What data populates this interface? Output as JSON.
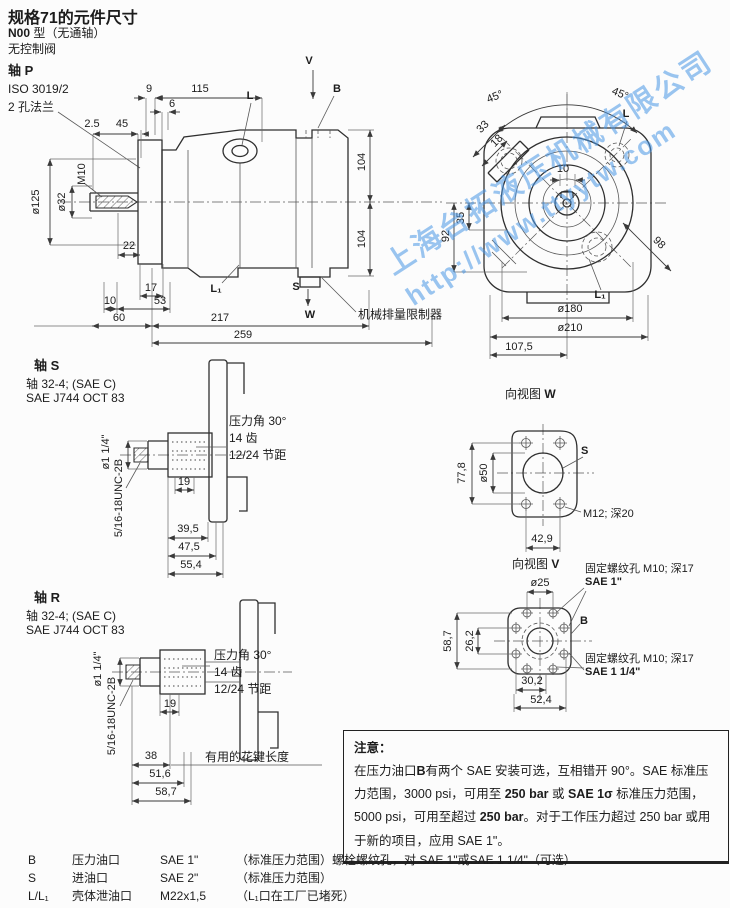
{
  "header": {
    "title": "规格71的元件尺寸",
    "model": "N00",
    "model_rest": " 型（无通轴）",
    "subtitle": "无控制阀"
  },
  "watermark": {
    "company": "上海台拓液压机械有限公司",
    "url": "http://www.ttyytw.com",
    "color": "#4a97e6"
  },
  "shaft_p": {
    "heading": "轴 P",
    "flange_std": "ISO 3019/2",
    "flange_type": "2 孔法兰",
    "dims": {
      "d9": "9",
      "d115": "115",
      "d6": "6",
      "d2_5": "2.5",
      "d45": "45",
      "dia125": "ø125",
      "dia32": "ø32",
      "m10": "M10",
      "d22": "22",
      "d17": "17",
      "d10": "10",
      "d53": "53",
      "d60": "60",
      "d217": "217",
      "d259": "259",
      "d104_top": "104",
      "d104_bottom": "104"
    },
    "ports": {
      "v": "V",
      "b": "B",
      "l": "L",
      "l1": "L₁",
      "s": "S",
      "w": "W"
    },
    "limiter_note": "机械排量限制器"
  },
  "rear_view": {
    "dims": {
      "a45_left": "45°",
      "a45_right": "45°",
      "d33": "33",
      "d18": "18",
      "d10": "10",
      "d92": "92",
      "d35": "35",
      "d98": "98",
      "dia180": "ø180",
      "dia210": "ø210",
      "d107_5": "107,5"
    },
    "ports": {
      "l": "L",
      "l1": "L₁"
    }
  },
  "shaft_s": {
    "heading": "轴 S",
    "spec_line1": "轴 32-4; (SAE C)",
    "spec_line2": "SAE J744 OCT 83",
    "dia": "ø1 1/4\"",
    "thread": "5/16-18UNC-2B",
    "dims": {
      "d19": "19",
      "d39_5": "39,5",
      "d47_5": "47,5",
      "d55_4": "55,4"
    },
    "spline": {
      "angle": "压力角 30°",
      "teeth": "14 齿",
      "pitch": "12/24 节距"
    }
  },
  "view_w": {
    "title_prefix": "向视图 ",
    "letter": "W",
    "dims": {
      "d77_8": "77,8",
      "dia50": "ø50",
      "d42_9": "42,9"
    },
    "port": "S",
    "hole_note": "M12; 深20"
  },
  "shaft_r": {
    "heading": "轴 R",
    "spec_line1": "轴 32-4; (SAE C)",
    "spec_line2": "SAE J744 OCT 83",
    "dia": "ø1 1/4\"",
    "thread": "5/16-18UNC-2B",
    "dims": {
      "d19": "19",
      "d38": "38",
      "d51_6": "51,6",
      "d58_7": "58,7"
    },
    "spline_length_note": "有用的花键长度",
    "spline": {
      "angle": "压力角 30°",
      "teeth": "14 齿",
      "pitch": "12/24 节距"
    }
  },
  "view_v": {
    "title_prefix": "向视图 ",
    "letter": "V",
    "dims": {
      "dia25": "ø25",
      "d58_7": "58,7",
      "d26_2": "26,2",
      "d30_2": "30,2",
      "d52_4": "52,4"
    },
    "port": "B",
    "fixing_note_top": "固定螺纹孔 M10; 深17",
    "sae_top": "SAE 1\"",
    "fixing_note_bottom": "固定螺纹孔 M10; 深17",
    "sae_bottom": "SAE 1 1/4\""
  },
  "note": {
    "title": "注意：",
    "s1": "在压力油口",
    "b1": "B",
    "s2": "有两个 SAE 安装可选，互相错开 90°。SAE 标准压力范围，3000 psi，可用至 ",
    "b2": "250 bar",
    "s3": " 或 ",
    "b3": "SAE 1σ",
    "s4": " 标准压力范围，5000 psi，可用至超过 ",
    "b4": "250 bar",
    "s5": "。对于工作压力超过 250 bar 或用于新的项目，应用 SAE 1\"。"
  },
  "ports_table": {
    "rows": [
      {
        "code": "B",
        "name": "压力油口",
        "size": "SAE 1\"",
        "remark": "（标准压力范围）螺栓螺纹孔，对 SAE 1\"或SAE 1 1/4\"（可选）"
      },
      {
        "code": "S",
        "name": "进油口",
        "size": "SAE 2\"",
        "remark": "（标准压力范围）"
      },
      {
        "code": "L/L₁",
        "name": "壳体泄油口",
        "size": "M22x1,5",
        "remark": "（L₁口在工厂已堵死）"
      }
    ]
  }
}
